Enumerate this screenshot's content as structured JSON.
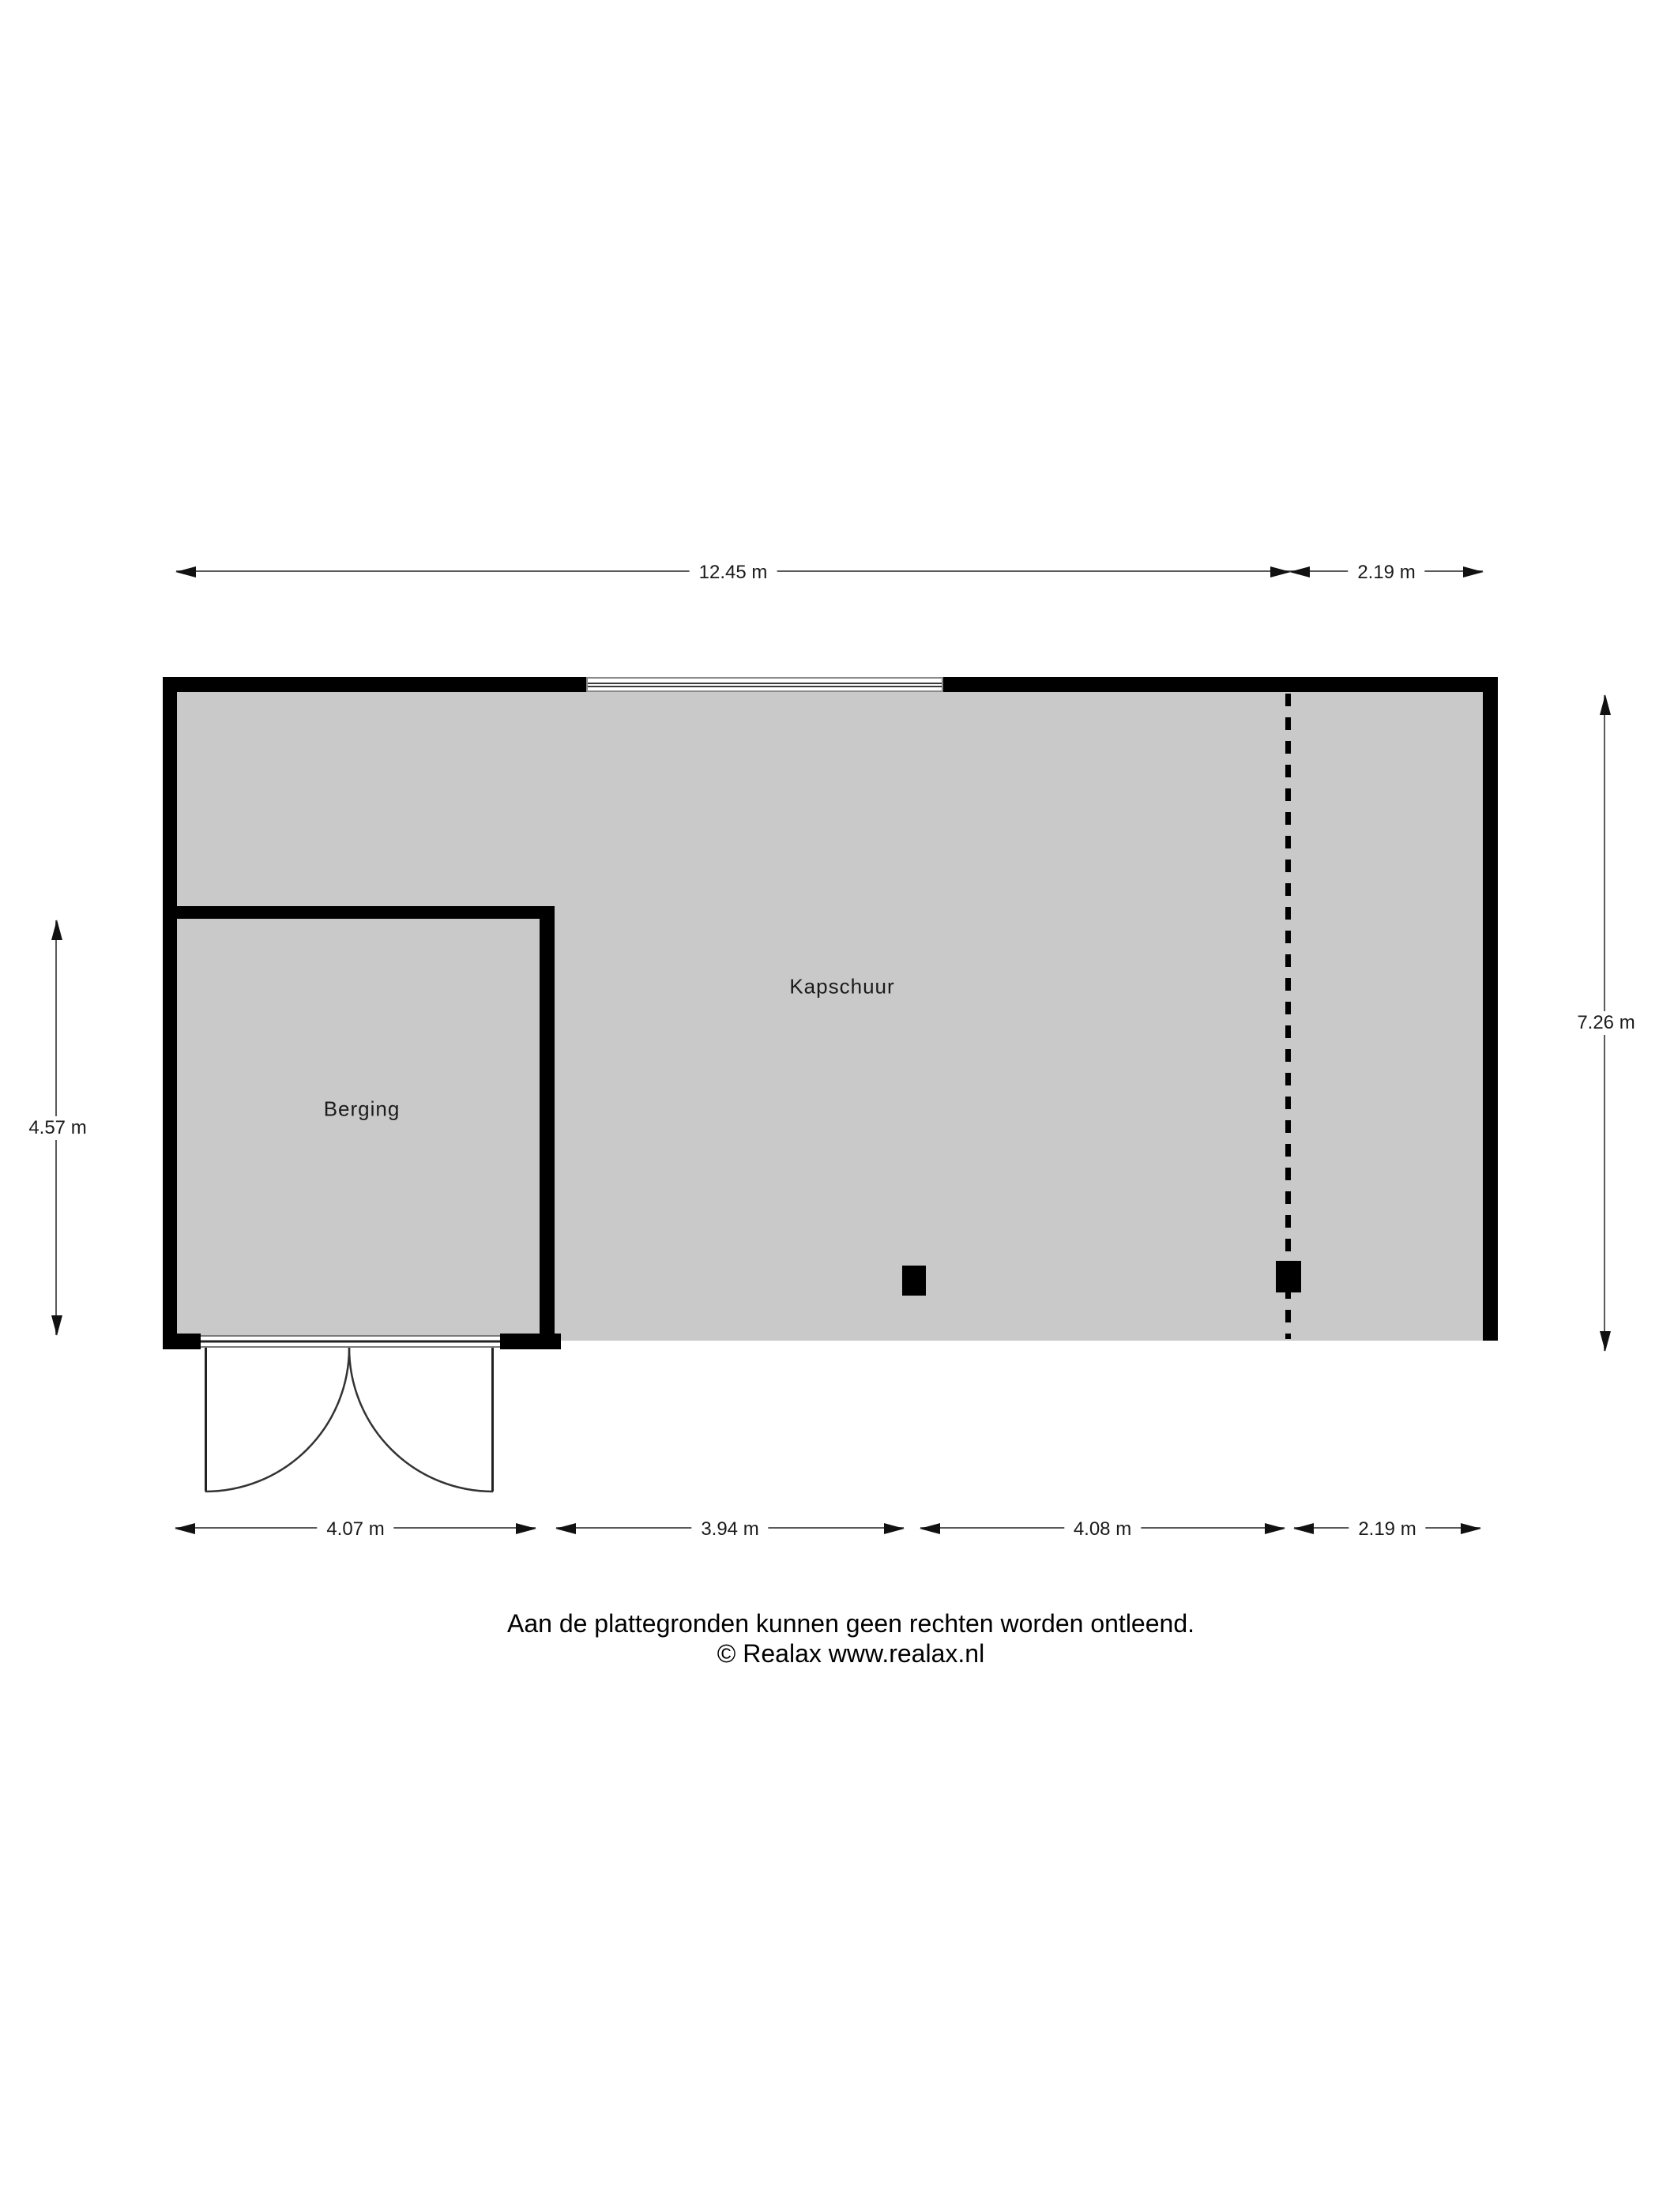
{
  "labels": {
    "kapschuur": "Kapschuur",
    "berging": "Berging"
  },
  "dims": {
    "top_main": "12.45 m",
    "top_right": "2.19 m",
    "right": "7.26 m",
    "left": "4.57 m",
    "bottom_1": "4.07 m",
    "bottom_2": "3.94 m",
    "bottom_3": "4.08 m",
    "bottom_4": "2.19 m"
  },
  "footer": {
    "line1": "Aan de plattegronden kunnen geen rechten worden ontleend.",
    "line2": "© Realax www.realax.nl"
  },
  "colors": {
    "floor": "#c9c9c9",
    "wall": "#000000",
    "dim_line": "#5a5a5a"
  }
}
